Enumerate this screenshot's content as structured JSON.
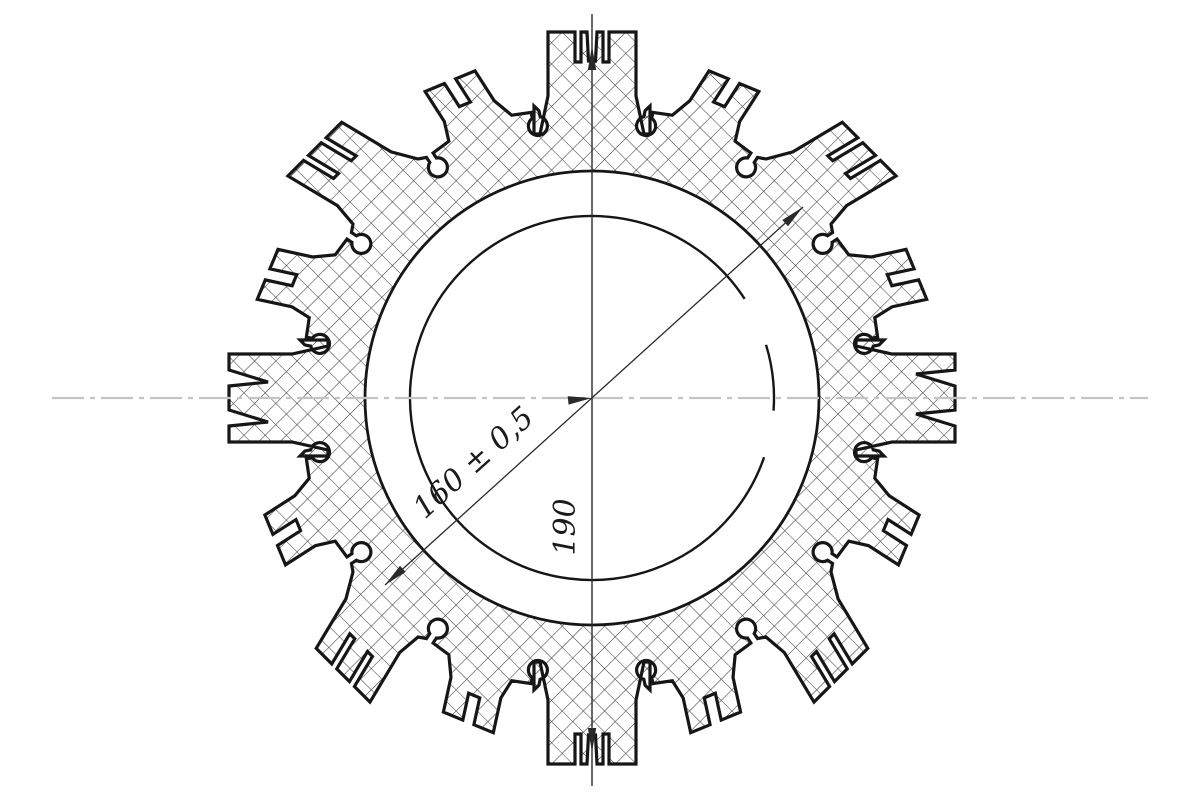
{
  "meta": {
    "type": "engineering-drawing",
    "view": "cross-section of toothed ring profile",
    "background": "#ffffff"
  },
  "dimensions": {
    "bore_diameter": {
      "label": "160 ± 0,5"
    },
    "vertical": {
      "label": "190"
    }
  },
  "colors": {
    "outline": "#161616",
    "thin_line": "#2a2a2a",
    "hatch": "#3a3a3a",
    "centerline": "#c4c4c4",
    "text": "#1b1b1b",
    "background": "#ffffff"
  },
  "geometry": {
    "center": {
      "x": 592,
      "y": 398
    },
    "ring_inner_radius": 227,
    "bore_radius": 182,
    "bore_arc_segments_deg": [
      [
        33,
        341
      ],
      [
        356,
        377
      ]
    ],
    "cluster_count": 16,
    "step_deg": 22.5,
    "plateau_r": 292,
    "keyhole": {
      "half_width": 4,
      "mouth_r": 292,
      "neck_r": 286,
      "ball_r": 9.5,
      "offset_deg": 11.25
    },
    "tilt": {
      "DIAG": 0.25,
      "OFF": 0.18
    },
    "half_widths": {
      "NS": 52,
      "EW": 52,
      "DIAG": 46,
      "OFF": 34
    },
    "base_r": {
      "NS": 264,
      "EW": 264,
      "DIAG": 292,
      "OFF": 292
    },
    "profiles": {
      "NS": [
        [
          -52,
          264
        ],
        [
          -44,
          302
        ],
        [
          -44,
          366
        ],
        [
          -17,
          366
        ],
        [
          -17,
          336
        ],
        [
          -11,
          336
        ],
        [
          -11,
          366
        ],
        [
          -5,
          366
        ],
        [
          -3.5,
          337
        ],
        [
          3.5,
          337
        ],
        [
          5,
          366
        ],
        [
          11,
          366
        ],
        [
          11,
          336
        ],
        [
          17,
          336
        ],
        [
          17,
          366
        ],
        [
          44,
          366
        ],
        [
          44,
          302
        ],
        [
          52,
          264
        ]
      ],
      "EW": [
        [
          -52,
          264
        ],
        [
          -44,
          300
        ],
        [
          -44,
          363
        ],
        [
          -28,
          363
        ],
        [
          -24,
          324
        ],
        [
          -12,
          363
        ],
        [
          12,
          363
        ],
        [
          16,
          324
        ],
        [
          28,
          363
        ],
        [
          44,
          363
        ],
        [
          44,
          300
        ],
        [
          52,
          264
        ]
      ],
      "DIAG": [
        [
          -46,
          292
        ],
        [
          -38,
          316
        ],
        [
          -38,
          372
        ],
        [
          -16,
          372
        ],
        [
          -16,
          338
        ],
        [
          -9,
          338
        ],
        [
          -9,
          372
        ],
        [
          9,
          372
        ],
        [
          9,
          338
        ],
        [
          16,
          338
        ],
        [
          16,
          372
        ],
        [
          38,
          372
        ],
        [
          38,
          316
        ],
        [
          46,
          292
        ]
      ],
      "OFF": [
        [
          -34,
          292
        ],
        [
          -27,
          312
        ],
        [
          -27,
          347
        ],
        [
          -6,
          347
        ],
        [
          -6,
          320
        ],
        [
          6,
          320
        ],
        [
          6,
          347
        ],
        [
          27,
          347
        ],
        [
          27,
          312
        ],
        [
          34,
          292
        ]
      ]
    },
    "hatch_spacing": 15,
    "dim_lines": {
      "vertical": {
        "x": 592,
        "y1": 14,
        "y2": 786
      },
      "diagonal": {
        "x1": 385,
        "y1": 585,
        "x2": 803,
        "y2": 207
      }
    },
    "arrows": [
      [
        592,
        46,
        0,
        -1
      ],
      [
        592,
        752,
        0,
        1
      ],
      [
        385,
        585,
        -0.742,
        0.67
      ],
      [
        803,
        207,
        0.743,
        -0.672
      ],
      [
        592,
        398,
        0.995,
        -0.1
      ]
    ],
    "centerline": {
      "y": 398,
      "x1": 52,
      "x2": 1148
    },
    "labels": {
      "bore": {
        "x": 480,
        "y": 470,
        "rotate": -42
      },
      "vertical": {
        "x": 575,
        "y": 527,
        "rotate": -90
      }
    }
  }
}
